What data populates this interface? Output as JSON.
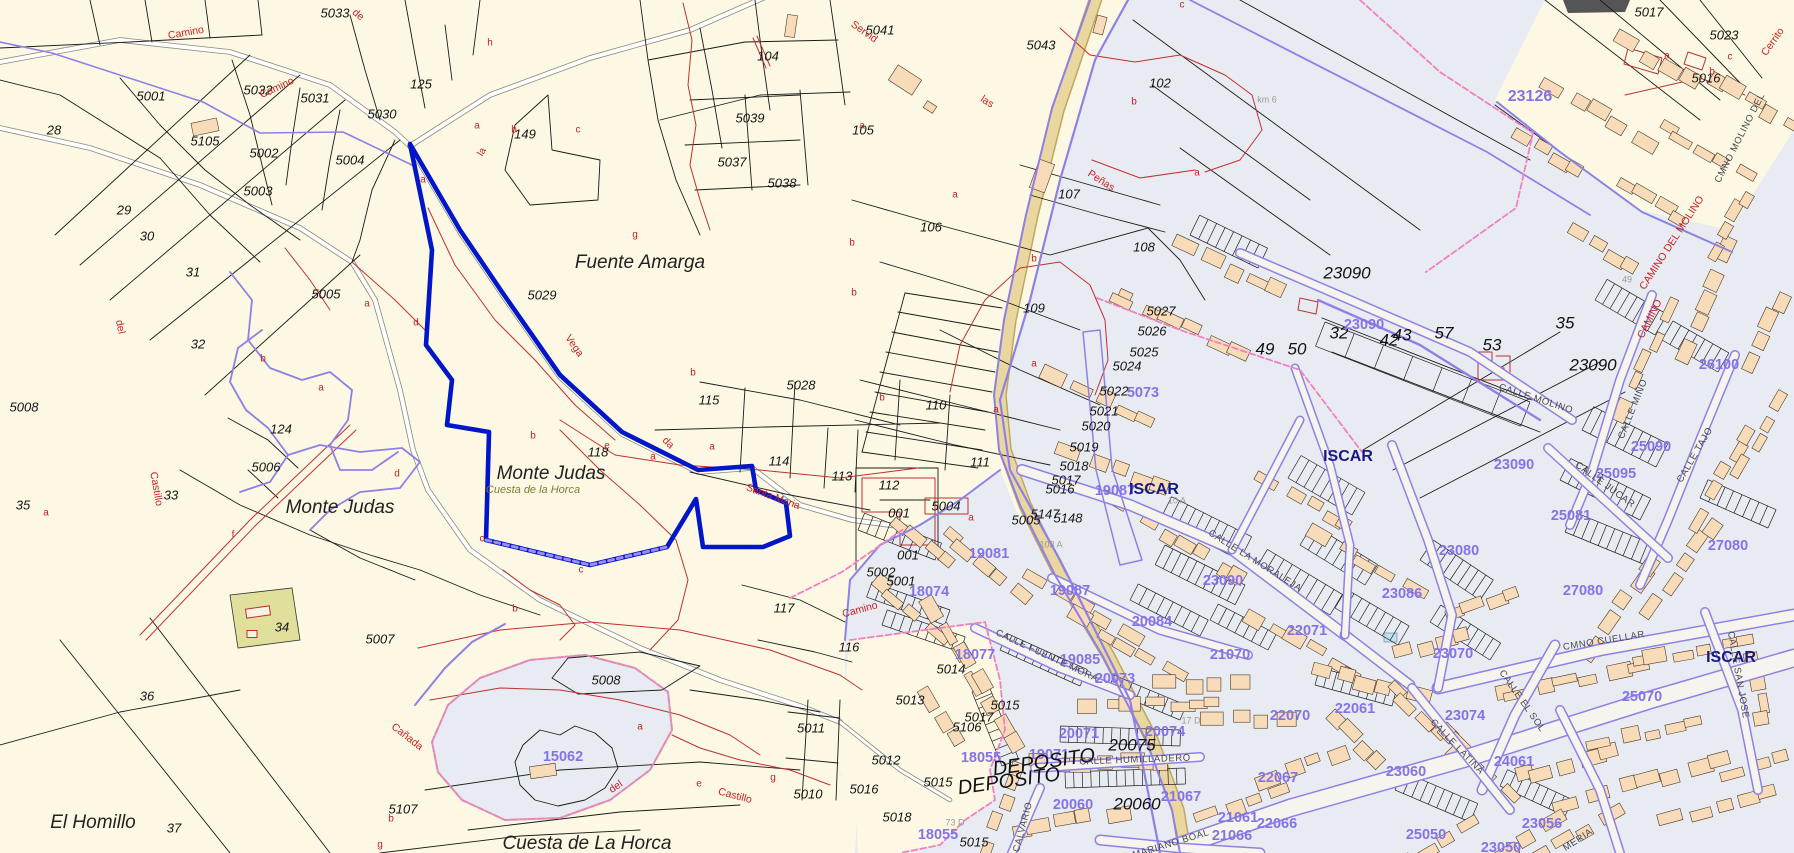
{
  "map": {
    "description": "Cadastral cartography view of rural parcels and the town of Iscar",
    "colors": {
      "rural_bg": "#fdf8e3",
      "urban_bg": "#e8ecf2",
      "parcel_line": "#1a1a1a",
      "contour_red": "#c03030",
      "cadastral_purple": "#8f80e5",
      "selected_blue": "#0016c8",
      "road_tan": "#ead7a0",
      "building_salmon": "#f8dcba",
      "town_navy": "#181880",
      "block_label_purple": "#8473e8",
      "olive_parcel": "#e0e09c",
      "pink_dash": "#f080c0"
    },
    "labels": [
      [
        "5033",
        335,
        14,
        "p",
        0
      ],
      [
        "5031",
        315,
        99,
        "p",
        0
      ],
      [
        "5032",
        258,
        91,
        "p",
        0
      ],
      [
        "125",
        421,
        85,
        "p",
        0
      ],
      [
        "5030",
        382,
        115,
        "p",
        0
      ],
      [
        "5001",
        151,
        97,
        "p",
        0
      ],
      [
        "28",
        54,
        131,
        "p",
        0
      ],
      [
        "5105",
        205,
        142,
        "p",
        0
      ],
      [
        "5002",
        264,
        154,
        "p",
        0
      ],
      [
        "5004",
        350,
        161,
        "p",
        0
      ],
      [
        "5003",
        258,
        192,
        "p",
        0
      ],
      [
        "29",
        124,
        211,
        "p",
        0
      ],
      [
        "30",
        147,
        237,
        "p",
        0
      ],
      [
        "31",
        193,
        273,
        "p",
        0
      ],
      [
        "32",
        198,
        345,
        "p",
        0
      ],
      [
        "5005",
        326,
        295,
        "p",
        0
      ],
      [
        "149",
        525,
        135,
        "p",
        0
      ],
      [
        "104",
        768,
        57,
        "p",
        0
      ],
      [
        "5039",
        750,
        119,
        "p",
        0
      ],
      [
        "5037",
        732,
        163,
        "p",
        0
      ],
      [
        "5038",
        782,
        184,
        "p",
        0
      ],
      [
        "105",
        863,
        131,
        "p",
        0
      ],
      [
        "5041",
        880,
        31,
        "p",
        0
      ],
      [
        "5043",
        1041,
        46,
        "p",
        0
      ],
      [
        "102",
        1160,
        84,
        "p",
        0
      ],
      [
        "107",
        1069,
        195,
        "p",
        0
      ],
      [
        "106",
        931,
        228,
        "p",
        0
      ],
      [
        "108",
        1144,
        248,
        "p",
        0
      ],
      [
        "109",
        1034,
        309,
        "p",
        0
      ],
      [
        "110",
        936,
        406,
        "p",
        0
      ],
      [
        "111",
        980,
        463,
        "p",
        0
      ],
      [
        "112",
        889,
        486,
        "p",
        0
      ],
      [
        "113",
        842,
        477,
        "p",
        0
      ],
      [
        "114",
        779,
        462,
        "p",
        0
      ],
      [
        "115",
        709,
        401,
        "p",
        0
      ],
      [
        "5028",
        801,
        386,
        "p",
        0
      ],
      [
        "5029",
        542,
        296,
        "p",
        0
      ],
      [
        "118",
        598,
        453,
        "p",
        0
      ],
      [
        "117",
        784,
        609,
        "p",
        0
      ],
      [
        "116",
        849,
        648,
        "p",
        0
      ],
      [
        "124",
        281,
        430,
        "p",
        0
      ],
      [
        "5006",
        266,
        468,
        "p",
        0
      ],
      [
        "33",
        171,
        496,
        "p",
        0
      ],
      [
        "35",
        23,
        506,
        "p",
        0
      ],
      [
        "5008",
        24,
        408,
        "p",
        0
      ],
      [
        "34",
        282,
        628,
        "p",
        0
      ],
      [
        "5007",
        380,
        640,
        "p",
        0
      ],
      [
        "5107",
        403,
        810,
        "p",
        0
      ],
      [
        "36",
        147,
        697,
        "p",
        0
      ],
      [
        "37",
        174,
        829,
        "p",
        0
      ],
      [
        "5008",
        606,
        681,
        "p",
        0
      ],
      [
        "5011",
        811,
        729,
        "p",
        0
      ],
      [
        "5010",
        808,
        795,
        "p",
        0
      ],
      [
        "5027",
        1161,
        312,
        "p",
        0
      ],
      [
        "5026",
        1152,
        332,
        "p",
        0
      ],
      [
        "5025",
        1144,
        353,
        "p",
        0
      ],
      [
        "5024",
        1127,
        367,
        "p",
        0
      ],
      [
        "5022",
        1114,
        392,
        "p",
        0
      ],
      [
        "5021",
        1104,
        412,
        "p",
        0
      ],
      [
        "5020",
        1096,
        427,
        "p",
        0
      ],
      [
        "5019",
        1084,
        448,
        "p",
        0
      ],
      [
        "5018",
        1074,
        467,
        "p",
        0
      ],
      [
        "5017",
        1066,
        481,
        "p",
        0
      ],
      [
        "5016",
        1060,
        490,
        "p",
        0
      ],
      [
        "5005",
        1026,
        521,
        "p",
        0
      ],
      [
        "5147",
        1045,
        515,
        "p",
        0
      ],
      [
        "5148",
        1068,
        519,
        "p",
        0
      ],
      [
        "5004",
        946,
        507,
        "p",
        0
      ],
      [
        "001",
        899,
        514,
        "p",
        0
      ],
      [
        "001",
        908,
        556,
        "p",
        0
      ],
      [
        "5002",
        881,
        573,
        "p",
        0
      ],
      [
        "5001",
        901,
        582,
        "p",
        0
      ],
      [
        "5014",
        951,
        670,
        "p",
        0
      ],
      [
        "5013",
        910,
        701,
        "p",
        0
      ],
      [
        "5015",
        1005,
        706,
        "p",
        0
      ],
      [
        "5017",
        979,
        718,
        "p",
        0
      ],
      [
        "5106",
        967,
        728,
        "p",
        0
      ],
      [
        "5012",
        886,
        761,
        "p",
        0
      ],
      [
        "5015",
        938,
        783,
        "p",
        0
      ],
      [
        "5016",
        864,
        790,
        "p",
        0
      ],
      [
        "5018",
        897,
        818,
        "p",
        0
      ],
      [
        "5015",
        974,
        843,
        "p",
        0
      ],
      [
        "5017",
        1649,
        13,
        "p",
        0
      ],
      [
        "5023",
        1724,
        36,
        "p",
        0
      ],
      [
        "5016",
        1706,
        79,
        "p",
        0
      ],
      [
        "23090",
        1347,
        274,
        "P",
        0
      ],
      [
        "23090",
        1593,
        366,
        "P",
        0
      ],
      [
        "49",
        1265,
        350,
        "P",
        0
      ],
      [
        "50",
        1297,
        350,
        "P",
        0
      ],
      [
        "32",
        1339,
        334,
        "P",
        0
      ],
      [
        "42",
        1389,
        341,
        "P",
        0
      ],
      [
        "43",
        1402,
        336,
        "P",
        0
      ],
      [
        "57",
        1444,
        334,
        "P",
        0
      ],
      [
        "53",
        1492,
        346,
        "P",
        0
      ],
      [
        "35",
        1565,
        324,
        "P",
        0
      ],
      [
        "20075",
        1132,
        746,
        "P",
        0
      ],
      [
        "20060",
        1137,
        805,
        "P",
        0
      ],
      [
        "23126",
        1530,
        97,
        "B",
        0
      ],
      [
        "23090",
        1364,
        325,
        "b",
        0
      ],
      [
        "23090",
        1514,
        465,
        "b",
        0
      ],
      [
        "23090",
        1223,
        581,
        "b",
        0
      ],
      [
        "26100",
        1719,
        365,
        "b",
        0
      ],
      [
        "25090",
        1651,
        447,
        "b",
        0
      ],
      [
        "25095",
        1616,
        474,
        "b",
        0
      ],
      [
        "25081",
        1571,
        516,
        "b",
        0
      ],
      [
        "27080",
        1728,
        546,
        "b",
        0
      ],
      [
        "27080",
        1583,
        591,
        "b",
        0
      ],
      [
        "23080",
        1459,
        551,
        "b",
        0
      ],
      [
        "23086",
        1402,
        594,
        "b",
        0
      ],
      [
        "22071",
        1307,
        631,
        "b",
        0
      ],
      [
        "5073",
        1143,
        393,
        "b",
        0
      ],
      [
        "19087",
        1115,
        491,
        "b",
        0
      ],
      [
        "19087",
        1070,
        591,
        "b",
        0
      ],
      [
        "19081",
        989,
        554,
        "b",
        0
      ],
      [
        "18074",
        929,
        592,
        "b",
        0
      ],
      [
        "20084",
        1152,
        622,
        "b",
        0
      ],
      [
        "15062",
        563,
        757,
        "b",
        0
      ],
      [
        "18077",
        975,
        655,
        "b",
        0
      ],
      [
        "19085",
        1080,
        660,
        "b",
        0
      ],
      [
        "20073",
        1115,
        679,
        "b",
        0
      ],
      [
        "21070",
        1230,
        655,
        "b",
        0
      ],
      [
        "23070",
        1453,
        654,
        "b",
        0
      ],
      [
        "22061",
        1355,
        709,
        "b",
        0
      ],
      [
        "23074",
        1465,
        716,
        "b",
        0
      ],
      [
        "25070",
        1642,
        697,
        "b",
        0
      ],
      [
        "23060",
        1406,
        772,
        "b",
        0
      ],
      [
        "24061",
        1514,
        762,
        "b",
        0
      ],
      [
        "20071",
        1079,
        734,
        "b",
        0
      ],
      [
        "20074",
        1165,
        732,
        "b",
        0
      ],
      [
        "18055",
        981,
        758,
        "b",
        0
      ],
      [
        "19071",
        1049,
        755,
        "b",
        0
      ],
      [
        "20060",
        1073,
        805,
        "b",
        0
      ],
      [
        "21067",
        1181,
        797,
        "b",
        0
      ],
      [
        "22070",
        1290,
        716,
        "b",
        0
      ],
      [
        "22067",
        1278,
        778,
        "b",
        0
      ],
      [
        "21061",
        1238,
        818,
        "b",
        0
      ],
      [
        "22066",
        1277,
        824,
        "b",
        0
      ],
      [
        "21066",
        1232,
        836,
        "b",
        0
      ],
      [
        "18055",
        938,
        835,
        "b",
        0
      ],
      [
        "25050",
        1426,
        835,
        "b",
        0
      ],
      [
        "23056",
        1542,
        824,
        "b",
        0
      ],
      [
        "23050",
        1501,
        848,
        "b",
        0
      ],
      [
        "Fuente Amarga",
        640,
        263,
        "n",
        0
      ],
      [
        "Monte Judas",
        340,
        508,
        "n",
        0
      ],
      [
        "Monte Judas",
        551,
        474,
        "n",
        0
      ],
      [
        "El Homillo",
        93,
        823,
        "n",
        0
      ],
      [
        "Cuesta de La Horca",
        587,
        844,
        "n",
        0
      ],
      [
        "Cuesta de la Horca",
        533,
        490,
        "o",
        0
      ],
      [
        "ISCAR",
        1154,
        490,
        "t",
        0
      ],
      [
        "ISCAR",
        1348,
        457,
        "t",
        0
      ],
      [
        "ISCAR",
        1731,
        658,
        "t",
        0
      ],
      [
        "DEPOSITO",
        1044,
        763,
        "D",
        -8
      ],
      [
        "DEPOSITO",
        1009,
        782,
        "D",
        -8
      ],
      [
        "Camino",
        186,
        33,
        "r",
        -10
      ],
      [
        "Camino",
        277,
        88,
        "r",
        -25
      ],
      [
        "de",
        358,
        15,
        "r",
        40
      ],
      [
        "Servid",
        864,
        32,
        "r",
        35
      ],
      [
        "las",
        987,
        102,
        "r",
        33
      ],
      [
        "Peñas",
        1101,
        181,
        "r",
        33
      ],
      [
        "Vega",
        574,
        346,
        "r",
        55
      ],
      [
        "da",
        668,
        443,
        "r",
        45
      ],
      [
        "Santa Maria",
        773,
        497,
        "r",
        20
      ],
      [
        "Camino",
        860,
        610,
        "r",
        -15
      ],
      [
        "del",
        120,
        327,
        "r",
        78
      ],
      [
        "Castillo",
        156,
        489,
        "r",
        80
      ],
      [
        "Cañada",
        407,
        737,
        "r",
        38
      ],
      [
        "del",
        616,
        787,
        "r",
        -35
      ],
      [
        "Castillo",
        735,
        796,
        "r",
        15
      ],
      [
        "Cerrito",
        1773,
        42,
        "r",
        -55
      ],
      [
        "CAMINO DEL MOLINO",
        1672,
        243,
        "r",
        -57
      ],
      [
        "CAMINO",
        1650,
        319,
        "r",
        -63
      ],
      [
        "CMNO MOLINO DEL",
        1740,
        138,
        "s",
        -63
      ],
      [
        "CALLE MOLINO",
        1536,
        399,
        "s",
        18
      ],
      [
        "CALLE MIÑO",
        1633,
        409,
        "s",
        -68
      ],
      [
        "CALLE TAJO",
        1695,
        455,
        "s",
        -60
      ],
      [
        "CALLE JUCAR",
        1605,
        485,
        "s",
        36
      ],
      [
        "CALLE LA MORALEJA",
        1255,
        561,
        "s",
        32
      ],
      [
        "CMNO CUELLAR",
        1604,
        641,
        "s",
        -9
      ],
      [
        "CALLE EL SOL",
        1522,
        701,
        "s",
        55
      ],
      [
        "CALLE LATINA",
        1457,
        747,
        "s",
        46
      ],
      [
        "CALLE SAN JOSE",
        1738,
        675,
        "s",
        80
      ],
      [
        "CALLE FUENTE MORA",
        1047,
        656,
        "s",
        25
      ],
      [
        "CALLE HUMILLADERO",
        1135,
        760,
        "s",
        -2
      ],
      [
        "MARIANO BOAL",
        1171,
        844,
        "s",
        -17
      ],
      [
        "CALVARIO",
        1023,
        827,
        "s",
        -75
      ],
      [
        "MERIA",
        1578,
        840,
        "s",
        -33
      ],
      [
        "km 6",
        1267,
        100,
        "g",
        0
      ],
      [
        "103 A",
        1051,
        545,
        "g",
        0
      ],
      [
        "10 A",
        1177,
        501,
        "g",
        0
      ],
      [
        "17 D",
        1191,
        721,
        "g",
        0
      ],
      [
        "73 D",
        955,
        823,
        "g",
        0
      ],
      [
        "49",
        1627,
        280,
        "g",
        0
      ],
      [
        "h",
        490,
        43,
        "L",
        0
      ],
      [
        "a",
        477,
        126,
        "L",
        0
      ],
      [
        "la",
        482,
        152,
        "L",
        -60
      ],
      [
        "b",
        514,
        130,
        "L",
        0
      ],
      [
        "c",
        578,
        130,
        "L",
        0
      ],
      [
        "a",
        423,
        180,
        "L",
        0
      ],
      [
        "a",
        862,
        126,
        "L",
        0
      ],
      [
        "c",
        1182,
        5,
        "L",
        0
      ],
      [
        "b",
        1134,
        102,
        "L",
        0
      ],
      [
        "a",
        955,
        195,
        "L",
        0
      ],
      [
        "a",
        1197,
        173,
        "L",
        0
      ],
      [
        "b",
        852,
        243,
        "L",
        0
      ],
      [
        "b",
        854,
        293,
        "L",
        0
      ],
      [
        "g",
        635,
        235,
        "L",
        0
      ],
      [
        "b",
        693,
        373,
        "L",
        0
      ],
      [
        "b",
        263,
        359,
        "L",
        0
      ],
      [
        "a",
        367,
        304,
        "L",
        0
      ],
      [
        "d",
        416,
        323,
        "L",
        0
      ],
      [
        "a",
        321,
        388,
        "L",
        0
      ],
      [
        "f",
        233,
        535,
        "L",
        0
      ],
      [
        "d",
        397,
        474,
        "L",
        0
      ],
      [
        "a",
        46,
        513,
        "L",
        0
      ],
      [
        "b",
        533,
        436,
        "L",
        0
      ],
      [
        "e",
        607,
        446,
        "L",
        0
      ],
      [
        "a",
        653,
        457,
        "L",
        0
      ],
      [
        "a",
        712,
        447,
        "L",
        0
      ],
      [
        "c",
        482,
        539,
        "L",
        0
      ],
      [
        "c",
        581,
        570,
        "L",
        0
      ],
      [
        "b",
        515,
        609,
        "L",
        0
      ],
      [
        "a",
        996,
        410,
        "L",
        0
      ],
      [
        "b",
        882,
        398,
        "L",
        0
      ],
      [
        "b",
        1034,
        259,
        "L",
        0
      ],
      [
        "a",
        1034,
        364,
        "L",
        0
      ],
      [
        "a",
        971,
        518,
        "L",
        0
      ],
      [
        "e",
        699,
        784,
        "L",
        0
      ],
      [
        "g",
        773,
        778,
        "L",
        0
      ],
      [
        "b",
        391,
        819,
        "L",
        0
      ],
      [
        "g",
        380,
        845,
        "L",
        0
      ],
      [
        "a",
        640,
        727,
        "L",
        0
      ],
      [
        "a",
        1667,
        56,
        "L",
        0
      ],
      [
        "c",
        1730,
        57,
        "L",
        0
      ],
      [
        "b",
        1712,
        72,
        "L",
        0
      ]
    ]
  }
}
